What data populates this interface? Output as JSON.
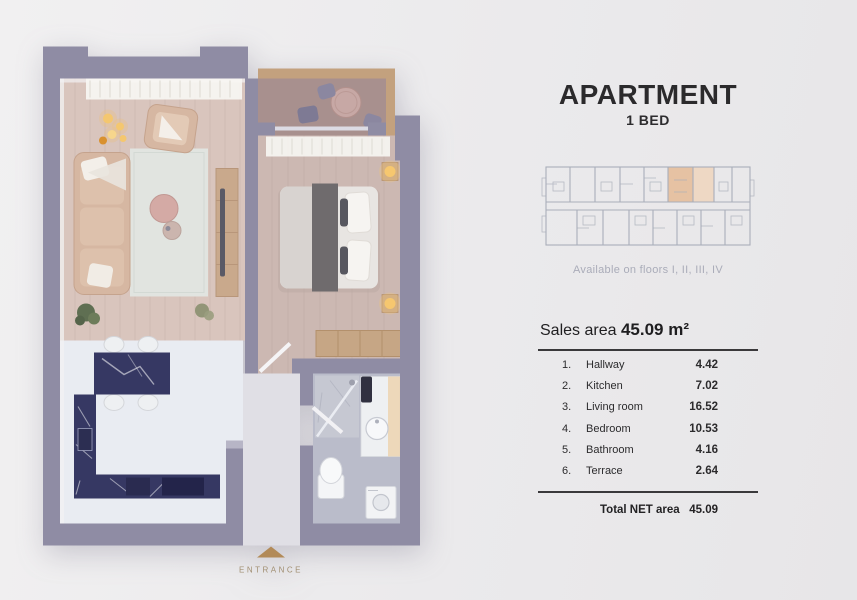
{
  "page": {
    "title": "APARTMENT",
    "subtitle": "1 BED",
    "availability": "Available on floors I, II, III, IV",
    "sales_area_label": "Sales area",
    "sales_area_value": "45.09 m²",
    "rooms": [
      {
        "num": "1.",
        "name": "Hallway",
        "area": "4.42"
      },
      {
        "num": "2.",
        "name": "Kitchen",
        "area": "7.02"
      },
      {
        "num": "3.",
        "name": "Living room",
        "area": "16.52"
      },
      {
        "num": "4.",
        "name": "Bedroom",
        "area": "10.53"
      },
      {
        "num": "5.",
        "name": "Bathroom",
        "area": "4.16"
      },
      {
        "num": "6.",
        "name": "Terrace",
        "area": "2.64"
      }
    ],
    "total_label": "Total NET area",
    "total_value": "45.09",
    "entrance_label": "ENTRANCE"
  },
  "colors": {
    "background": "#ebeaec",
    "wall": "#8f8ca4",
    "wood_floor": "#d9c5bd",
    "bedroom_floor": "#ccb8b2",
    "kitchen_floor": "#e9ecf2",
    "terrace_floor": "#a8908e",
    "bathroom_floor": "#babcca",
    "counter_dark": "#363863",
    "entrance_accent": "#b28a58",
    "highlighted_unit": "#e6c2a3",
    "schematic_line": "#a9aeba",
    "text_dark": "#2b2a2c",
    "text_muted": "#aaacb9"
  }
}
